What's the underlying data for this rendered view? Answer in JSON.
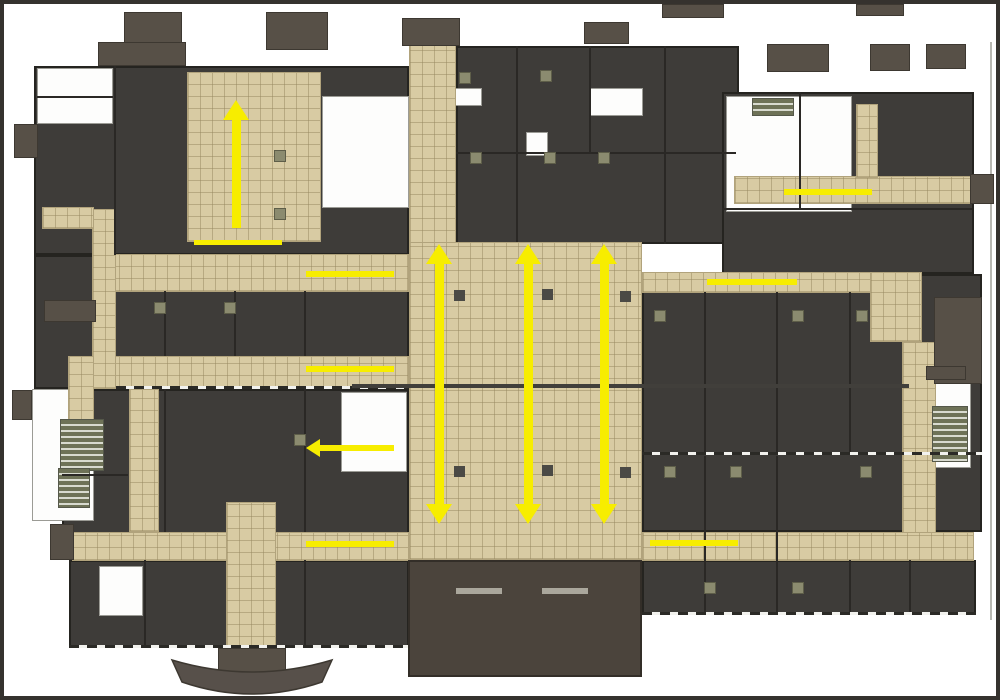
{
  "meta": {
    "description": "Building floor plan with tan circulation corridors and yellow flow arrows",
    "width": 1000,
    "height": 700
  },
  "colors": {
    "background": "#ffffff",
    "frame": "#35322e",
    "room_dark": "#3e3c39",
    "wall": "#2a2825",
    "corridor_tan": "#d8cba3",
    "corridor_grid": "#b1a37c",
    "roof_brown": "#575047",
    "lobby_brown": "#4b443c",
    "stair_green": "#6e7257",
    "column_olive": "#8b8b6f",
    "arrow_yellow": "#f7ed00"
  },
  "plan": {
    "dark_blocks": [
      {
        "n": "wing-upper-left",
        "x": 30,
        "y": 62,
        "w": 375,
        "h": 189
      },
      {
        "n": "wing-left-middle",
        "x": 30,
        "y": 251,
        "w": 375,
        "h": 134
      },
      {
        "n": "wing-left-lower",
        "x": 58,
        "y": 385,
        "w": 347,
        "h": 171
      },
      {
        "n": "wing-bottom-left",
        "x": 65,
        "y": 556,
        "w": 340,
        "h": 88
      },
      {
        "n": "wing-top-center",
        "x": 452,
        "y": 42,
        "w": 283,
        "h": 198
      },
      {
        "n": "wing-top-right",
        "x": 718,
        "y": 88,
        "w": 252,
        "h": 182
      },
      {
        "n": "wing-right-middle",
        "x": 638,
        "y": 270,
        "w": 340,
        "h": 258
      },
      {
        "n": "wing-bottom-right",
        "x": 638,
        "y": 556,
        "w": 334,
        "h": 55
      }
    ],
    "white_rooms": [
      {
        "n": "rooms-top-left-corner",
        "x": 33,
        "y": 64,
        "w": 76,
        "h": 56
      },
      {
        "n": "rooms-left-center",
        "x": 318,
        "y": 92,
        "w": 87,
        "h": 112
      },
      {
        "n": "rooms-far-left",
        "x": 28,
        "y": 385,
        "w": 62,
        "h": 132
      },
      {
        "n": "rooms-left-of-atrium",
        "x": 337,
        "y": 388,
        "w": 66,
        "h": 80
      },
      {
        "n": "rooms-top-right-interior",
        "x": 722,
        "y": 92,
        "w": 126,
        "h": 116
      },
      {
        "n": "stair-room-right",
        "x": 925,
        "y": 378,
        "w": 42,
        "h": 86
      },
      {
        "n": "room-top-center-a",
        "x": 585,
        "y": 84,
        "w": 54,
        "h": 28
      },
      {
        "n": "room-top-center-b",
        "x": 450,
        "y": 84,
        "w": 28,
        "h": 18
      },
      {
        "n": "room-top-center-c",
        "x": 522,
        "y": 128,
        "w": 22,
        "h": 24
      },
      {
        "n": "rooms-bottom-left-small",
        "x": 95,
        "y": 562,
        "w": 44,
        "h": 50
      }
    ],
    "corridors": [
      {
        "n": "corridor-top-vertical",
        "x": 405,
        "y": 36,
        "w": 47,
        "h": 204
      },
      {
        "n": "hall-upper-left",
        "x": 183,
        "y": 68,
        "w": 134,
        "h": 170
      },
      {
        "n": "corridor-left-upper",
        "x": 90,
        "y": 250,
        "w": 315,
        "h": 38
      },
      {
        "n": "corridor-left-lower",
        "x": 90,
        "y": 352,
        "w": 315,
        "h": 33
      },
      {
        "n": "corridor-left-connector",
        "x": 88,
        "y": 205,
        "w": 24,
        "h": 180
      },
      {
        "n": "corridor-left-stub",
        "x": 38,
        "y": 203,
        "w": 52,
        "h": 22
      },
      {
        "n": "corridor-left-down",
        "x": 64,
        "y": 352,
        "w": 26,
        "h": 80
      },
      {
        "n": "corridor-midleft-vertical",
        "x": 125,
        "y": 385,
        "w": 30,
        "h": 143
      },
      {
        "n": "corridor-bottom-left",
        "x": 68,
        "y": 528,
        "w": 337,
        "h": 29
      },
      {
        "n": "corridor-entry-vertical",
        "x": 222,
        "y": 498,
        "w": 50,
        "h": 148
      },
      {
        "n": "central-atrium",
        "x": 405,
        "y": 238,
        "w": 233,
        "h": 318
      },
      {
        "n": "corridor-right-upper",
        "x": 638,
        "y": 268,
        "w": 234,
        "h": 21
      },
      {
        "n": "corridor-right-jog",
        "x": 866,
        "y": 268,
        "w": 52,
        "h": 70
      },
      {
        "n": "corridor-right-vertical",
        "x": 898,
        "y": 338,
        "w": 34,
        "h": 192
      },
      {
        "n": "corridor-top-right",
        "x": 730,
        "y": 172,
        "w": 238,
        "h": 28
      },
      {
        "n": "corridor-top-right-stub",
        "x": 852,
        "y": 100,
        "w": 22,
        "h": 74
      },
      {
        "n": "corridor-bottom-right",
        "x": 638,
        "y": 528,
        "w": 332,
        "h": 29
      }
    ],
    "stairs": [
      {
        "n": "stair-left-a",
        "x": 56,
        "y": 415,
        "w": 44,
        "h": 52
      },
      {
        "n": "stair-left-b",
        "x": 54,
        "y": 464,
        "w": 32,
        "h": 40
      },
      {
        "n": "stair-right",
        "x": 928,
        "y": 402,
        "w": 36,
        "h": 56
      },
      {
        "n": "stair-top-right",
        "x": 748,
        "y": 94,
        "w": 42,
        "h": 18
      }
    ],
    "brown_blocks": [
      {
        "n": "roof-stub",
        "x": 120,
        "y": 8,
        "w": 58,
        "h": 32
      },
      {
        "n": "roof-stub",
        "x": 94,
        "y": 38,
        "w": 88,
        "h": 24
      },
      {
        "n": "roof-stub",
        "x": 262,
        "y": 8,
        "w": 62,
        "h": 38
      },
      {
        "n": "roof-stub",
        "x": 398,
        "y": 14,
        "w": 58,
        "h": 28
      },
      {
        "n": "roof-stub",
        "x": 580,
        "y": 18,
        "w": 45,
        "h": 22
      },
      {
        "n": "roof-stub",
        "x": 658,
        "y": 0,
        "w": 62,
        "h": 14
      },
      {
        "n": "roof-stub",
        "x": 763,
        "y": 40,
        "w": 62,
        "h": 28
      },
      {
        "n": "roof-stub",
        "x": 852,
        "y": 0,
        "w": 48,
        "h": 12
      },
      {
        "n": "roof-stub",
        "x": 866,
        "y": 40,
        "w": 40,
        "h": 27
      },
      {
        "n": "roof-stub",
        "x": 922,
        "y": 40,
        "w": 40,
        "h": 25
      },
      {
        "n": "roof-stub",
        "x": 10,
        "y": 120,
        "w": 24,
        "h": 34
      },
      {
        "n": "roof-stub",
        "x": 8,
        "y": 386,
        "w": 20,
        "h": 30
      },
      {
        "n": "roof-stub",
        "x": 40,
        "y": 296,
        "w": 52,
        "h": 22
      },
      {
        "n": "roof-stub",
        "x": 46,
        "y": 520,
        "w": 24,
        "h": 36
      },
      {
        "n": "roof-stub",
        "x": 966,
        "y": 170,
        "w": 24,
        "h": 30
      },
      {
        "n": "roof-block-right",
        "x": 930,
        "y": 293,
        "w": 48,
        "h": 87
      },
      {
        "n": "roof-stub",
        "x": 922,
        "y": 362,
        "w": 40,
        "h": 14
      },
      {
        "n": "canopy-center-block",
        "x": 214,
        "y": 644,
        "w": 68,
        "h": 38
      }
    ],
    "lobby": {
      "n": "main-entrance-lobby",
      "x": 404,
      "y": 556,
      "w": 234,
      "h": 117
    },
    "benches": [
      {
        "n": "lobby-bench",
        "x": 452,
        "y": 584,
        "w": 46,
        "h": 6
      },
      {
        "n": "lobby-bench",
        "x": 538,
        "y": 584,
        "w": 46,
        "h": 6
      }
    ],
    "partitions": [
      [
        110,
        62,
        2,
        189
      ],
      [
        33,
        92,
        76,
        2
      ],
      [
        160,
        287,
        2,
        65
      ],
      [
        230,
        287,
        2,
        65
      ],
      [
        300,
        287,
        2,
        65
      ],
      [
        160,
        385,
        2,
        143
      ],
      [
        300,
        385,
        2,
        143
      ],
      [
        140,
        556,
        2,
        88
      ],
      [
        300,
        556,
        2,
        88
      ],
      [
        512,
        42,
        2,
        196
      ],
      [
        585,
        42,
        2,
        108
      ],
      [
        660,
        42,
        2,
        198
      ],
      [
        452,
        148,
        280,
        2
      ],
      [
        795,
        88,
        2,
        118
      ],
      [
        718,
        204,
        250,
        2
      ],
      [
        700,
        288,
        2,
        162
      ],
      [
        772,
        288,
        2,
        162
      ],
      [
        845,
        288,
        2,
        162
      ],
      [
        700,
        452,
        2,
        104
      ],
      [
        772,
        452,
        2,
        104
      ],
      [
        700,
        556,
        2,
        55
      ],
      [
        772,
        556,
        2,
        55
      ],
      [
        845,
        556,
        2,
        55
      ],
      [
        905,
        556,
        2,
        55
      ],
      [
        58,
        470,
        66,
        2
      ]
    ],
    "light_lines": [
      [
        986,
        38,
        2,
        578
      ]
    ],
    "dash_lines": [
      [
        638,
        448,
        340,
        3
      ],
      [
        112,
        382,
        293,
        3
      ],
      [
        65,
        641,
        340,
        3
      ],
      [
        638,
        608,
        334,
        3
      ]
    ],
    "joint_line": {
      "n": "expansion-joint",
      "x": 348,
      "y": 380,
      "w": 557,
      "h": 4
    },
    "columns_dark": [
      [
        450,
        286
      ],
      [
        538,
        285
      ],
      [
        616,
        287
      ],
      [
        450,
        462
      ],
      [
        538,
        461
      ],
      [
        616,
        463
      ]
    ],
    "columns_olive": [
      [
        270,
        146
      ],
      [
        270,
        204
      ],
      [
        455,
        68
      ],
      [
        536,
        66
      ],
      [
        466,
        148
      ],
      [
        540,
        148
      ],
      [
        594,
        148
      ],
      [
        650,
        306
      ],
      [
        788,
        306
      ],
      [
        852,
        306
      ],
      [
        660,
        462
      ],
      [
        726,
        462
      ],
      [
        856,
        462
      ],
      [
        700,
        578
      ],
      [
        788,
        578
      ],
      [
        150,
        298
      ],
      [
        220,
        298
      ],
      [
        290,
        430
      ]
    ],
    "arrows": [
      {
        "n": "flow-arrow-up-upper-left",
        "o": "v",
        "cx": 232,
        "y1": 96,
        "y2": 224,
        "heads": [
          "up"
        ],
        "t": 9
      },
      {
        "n": "flow-line-upper-left",
        "o": "h",
        "y": 238,
        "x1": 190,
        "x2": 278,
        "heads": [],
        "t": 5
      },
      {
        "n": "flow-line-left-1",
        "o": "h",
        "y": 270,
        "x1": 302,
        "x2": 390,
        "heads": [],
        "t": 6
      },
      {
        "n": "flow-line-left-2",
        "o": "h",
        "y": 365,
        "x1": 302,
        "x2": 390,
        "heads": [],
        "t": 6
      },
      {
        "n": "flow-arrow-left-3",
        "o": "h",
        "y": 444,
        "x1": 302,
        "x2": 390,
        "heads": [
          "left"
        ],
        "t": 6
      },
      {
        "n": "flow-arrow-atrium-1",
        "o": "v",
        "cx": 435,
        "y1": 240,
        "y2": 520,
        "heads": [
          "up",
          "down"
        ],
        "t": 9
      },
      {
        "n": "flow-arrow-atrium-2",
        "o": "v",
        "cx": 524,
        "y1": 240,
        "y2": 520,
        "heads": [
          "up",
          "down"
        ],
        "t": 9
      },
      {
        "n": "flow-arrow-atrium-3",
        "o": "v",
        "cx": 600,
        "y1": 240,
        "y2": 520,
        "heads": [
          "up",
          "down"
        ],
        "t": 9
      },
      {
        "n": "flow-line-right-corridor",
        "o": "h",
        "y": 278,
        "x1": 703,
        "x2": 793,
        "heads": [],
        "t": 6
      },
      {
        "n": "flow-line-top-right",
        "o": "h",
        "y": 188,
        "x1": 780,
        "x2": 868,
        "heads": [],
        "t": 6
      },
      {
        "n": "flow-line-bottom-left",
        "o": "h",
        "y": 540,
        "x1": 302,
        "x2": 390,
        "heads": [],
        "t": 6
      },
      {
        "n": "flow-line-bottom-right",
        "o": "h",
        "y": 539,
        "x1": 646,
        "x2": 734,
        "heads": [],
        "t": 6
      }
    ]
  }
}
